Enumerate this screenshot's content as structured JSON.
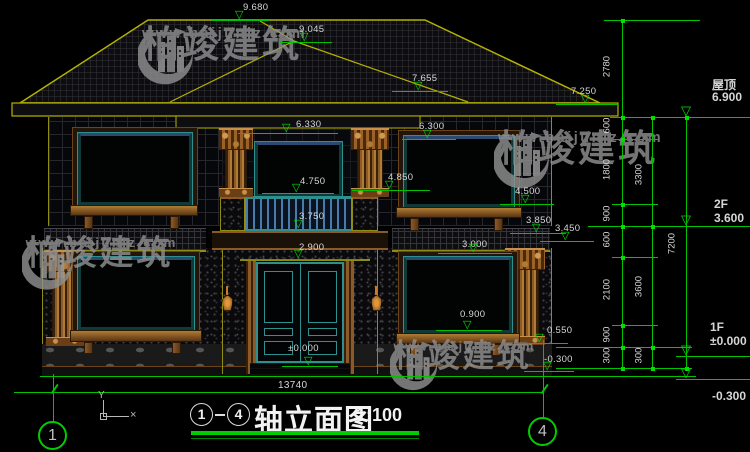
{
  "colors": {
    "background": "#000000",
    "dim_green": "#00c300",
    "marker_green": "#00e000",
    "dim_text": "#d6d6d6",
    "roof_yellow": "#b5b100",
    "trim_brown": "#8a5a28",
    "frame_teal": "#2e8f8f",
    "watermark_gray": "#8f8f8f",
    "lamp_orange": "#c87a28",
    "title_underline": "#00cc00"
  },
  "watermark": {
    "brand": "柏竣建筑",
    "site": "www.baijunjz.com",
    "instances": [
      {
        "x": 138,
        "y": 26,
        "s": 1
      },
      {
        "x": 494,
        "y": 130,
        "s": 1
      },
      {
        "x": 22,
        "y": 236,
        "s": 0.92
      },
      {
        "x": 390,
        "y": 340,
        "s": 0.86
      }
    ]
  },
  "glyphs": {
    "level_triangle": "▽"
  },
  "elevation_markers": [
    {
      "t": "9.680",
      "x": 243,
      "y": 2,
      "lx": 212,
      "lw": 58,
      "ly": 20
    },
    {
      "t": "9.045",
      "x": 299,
      "y": 24,
      "lx": 280,
      "lw": 52,
      "ly": 42
    },
    {
      "t": "7.655",
      "x": 412,
      "y": 73,
      "lx": 392,
      "lw": 56,
      "ly": 91
    },
    {
      "t": "7.250",
      "x": 571,
      "y": 86,
      "lx": 556,
      "lw": 62,
      "ly": 104
    },
    {
      "t": "6.330",
      "x": 296,
      "y": 119,
      "lx": 238,
      "lw": 100,
      "ly": 133
    },
    {
      "t": "6.300",
      "x": 419,
      "y": 121,
      "lx": 402,
      "lw": 54,
      "ly": 139
    },
    {
      "t": "4.850",
      "x": 388,
      "y": 172,
      "lx": 352,
      "lw": 78,
      "ly": 190
    },
    {
      "t": "4.750",
      "x": 300,
      "y": 176,
      "lx": 262,
      "lw": 72,
      "ly": 193
    },
    {
      "t": "4.500",
      "x": 515,
      "y": 186,
      "lx": 500,
      "lw": 54,
      "ly": 204
    },
    {
      "t": "3.850",
      "x": 526,
      "y": 215,
      "lx": 510,
      "lw": 56,
      "ly": 233
    },
    {
      "t": "3.750",
      "x": 299,
      "y": 211,
      "lx": 268,
      "lw": 64,
      "ly": 229
    },
    {
      "t": "3.450",
      "x": 555,
      "y": 223,
      "lx": 540,
      "lw": 54,
      "ly": 241
    },
    {
      "t": "3.000",
      "x": 462,
      "y": 239,
      "lx": 438,
      "lw": 74,
      "ly": 253
    },
    {
      "t": "2.900",
      "x": 299,
      "y": 242,
      "lx": 240,
      "lw": 120,
      "ly": 259
    },
    {
      "t": "0.900",
      "x": 460,
      "y": 309,
      "lx": 436,
      "lw": 66,
      "ly": 330
    },
    {
      "t": "0.550",
      "x": 547,
      "y": 325,
      "lx": 514,
      "lw": 54,
      "ly": 343
    },
    {
      "t": "±0.000",
      "x": 288,
      "y": 343,
      "lx": 282,
      "lw": 56,
      "ly": 366
    },
    {
      "t": "-0.300",
      "x": 544,
      "y": 354,
      "lx": 524,
      "lw": 50,
      "ly": 371
    }
  ],
  "right_levels": [
    {
      "label": "屋顶",
      "value": "6.900",
      "x": 712,
      "y": 76,
      "line_y": 117,
      "text_below": false
    },
    {
      "label": "2F",
      "value": "3.600",
      "x": 714,
      "y": 197,
      "line_y": 226,
      "text_below": false
    },
    {
      "label": "1F",
      "value": "±0.000",
      "x": 710,
      "y": 320,
      "line_y": 356,
      "text_below": false
    },
    {
      "label": "",
      "value": "-0.300",
      "x": 712,
      "y": 389,
      "line_y": 379,
      "text_below": true
    }
  ],
  "level_flag_x": 677,
  "dim_chains": [
    {
      "x": 622,
      "y1": 20,
      "y2": 368,
      "label_x": 601,
      "ticks": [
        20,
        117,
        139,
        204,
        226,
        257,
        325,
        347,
        368
      ],
      "labels": [
        {
          "t": "2780",
          "y": 68
        },
        {
          "t": "600",
          "y": 127
        },
        {
          "t": "1800",
          "y": 171
        },
        {
          "t": "900",
          "y": 215
        },
        {
          "t": "600",
          "y": 241
        },
        {
          "t": "2100",
          "y": 291
        },
        {
          "t": "900",
          "y": 336
        },
        {
          "t": "300",
          "y": 357
        }
      ]
    },
    {
      "x": 652,
      "y1": 117,
      "y2": 368,
      "label_x": 633,
      "ticks": [
        117,
        226,
        347,
        368
      ],
      "labels": [
        {
          "t": "3300",
          "y": 176
        },
        {
          "t": "3600",
          "y": 288
        },
        {
          "t": "300",
          "y": 357
        }
      ]
    },
    {
      "x": 686,
      "y1": 117,
      "y2": 368,
      "label_x": 666,
      "ticks": [
        117,
        368
      ],
      "labels": [
        {
          "t": "7200",
          "y": 245
        }
      ]
    }
  ],
  "green_lines": {
    "h": [
      [
        604,
        20,
        96
      ],
      [
        610,
        117,
        140
      ],
      [
        612,
        139,
        46
      ],
      [
        612,
        204,
        46
      ],
      [
        588,
        226,
        162
      ],
      [
        612,
        257,
        46
      ],
      [
        612,
        325,
        46
      ],
      [
        556,
        347,
        136
      ],
      [
        676,
        356,
        74
      ],
      [
        556,
        368,
        136
      ],
      [
        676,
        379,
        74
      ],
      [
        40,
        376,
        656
      ],
      [
        14,
        392,
        530
      ]
    ],
    "v": [
      [
        53,
        374,
        48
      ],
      [
        543,
        340,
        78
      ]
    ]
  },
  "bottom_width": {
    "value": "13740",
    "x": 278,
    "y": 380
  },
  "axis_bubbles": [
    {
      "n": "1",
      "x": 38,
      "y": 421
    },
    {
      "n": "4",
      "x": 528,
      "y": 417
    }
  ],
  "title": {
    "c1": "1",
    "c2": "4",
    "dash": "-",
    "text": "轴立面图",
    "scale": "1:100"
  },
  "ucs": {
    "y": "Y",
    "x": "×"
  }
}
